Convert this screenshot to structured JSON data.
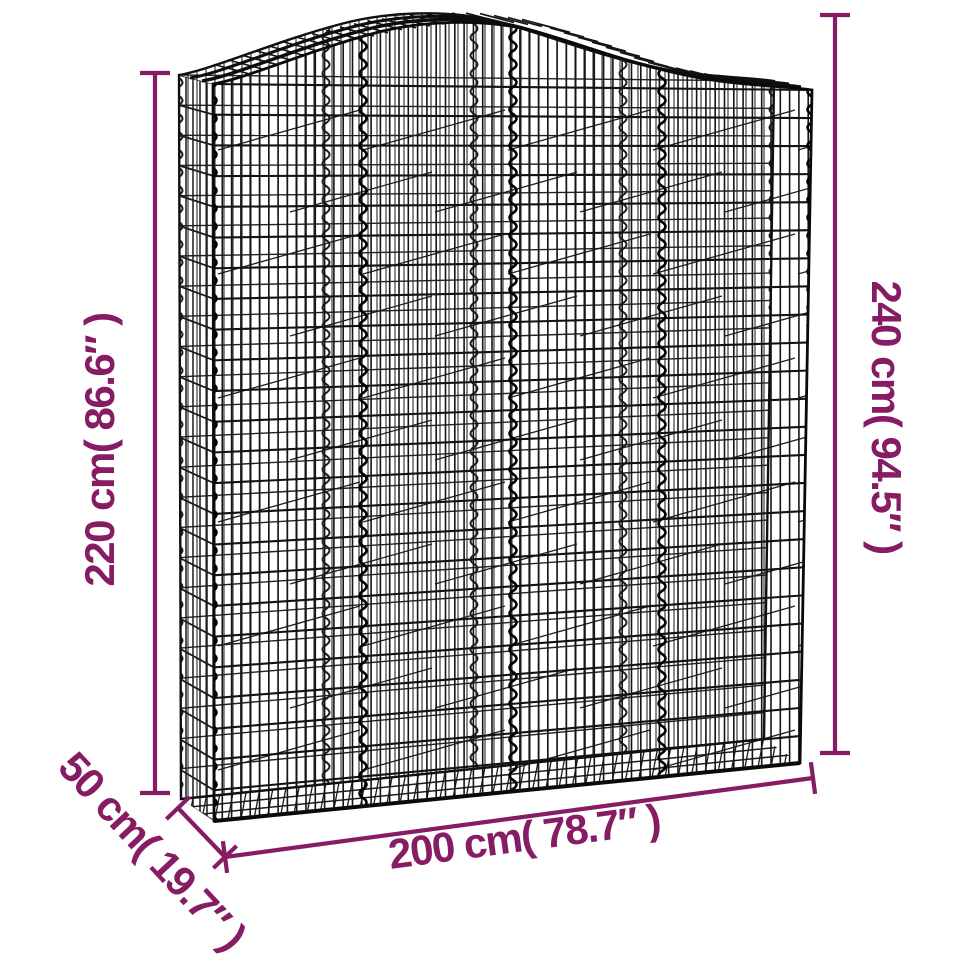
{
  "page": {
    "background_color": "#ffffff"
  },
  "illustration": {
    "subject": "arched gabion wire mesh basket",
    "wire_color": "#1b1b1b",
    "accent_color": "#861c63"
  },
  "dimensions": {
    "height_left": "220 cm( 86.6″ )",
    "height_right": "240 cm( 94.5″ )",
    "width_bottom": "200 cm( 78.7″ )",
    "depth": "50 cm( 19.7″ )"
  }
}
